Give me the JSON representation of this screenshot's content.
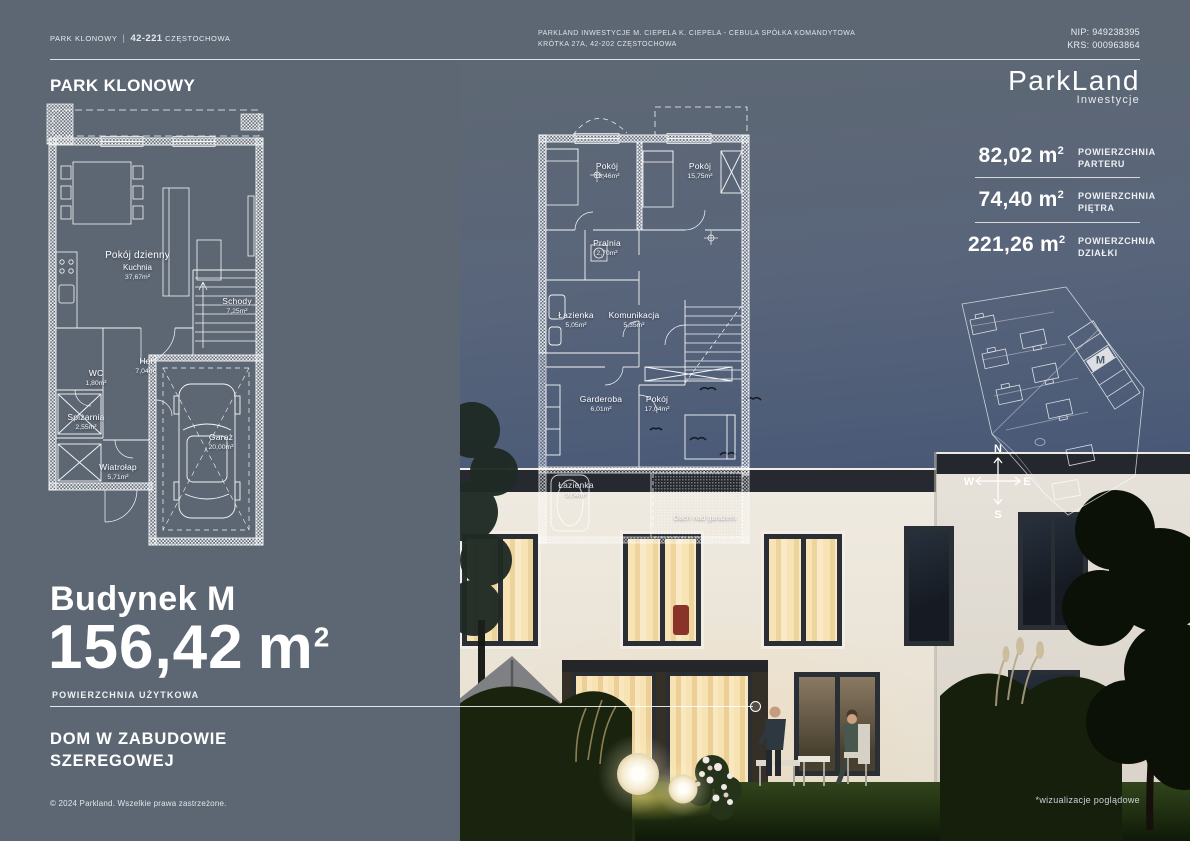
{
  "header": {
    "left_project": "PARK KLONOWY",
    "left_divider": "|",
    "left_zip": "42-221",
    "left_city": "CZĘSTOCHOWA",
    "center_line1": "PARKLAND INWESTYCJE M. CIEPELA K. CIEPELA - CEBULA SPÓŁKA KOMANDYTOWA",
    "center_line2": "KRÓTKA 27A, 42-202 CZĘSTOCHOWA",
    "nip": "NIP: 949238395",
    "krs": "KRS: 000963864"
  },
  "brand": {
    "name": "ParkLand",
    "subtitle": "Inwestycje"
  },
  "panel": {
    "project_title": "PARK KLONOWY",
    "building_title": "Budynek M",
    "area_value": "156,42",
    "area_unit": "m",
    "area_sup": "2",
    "area_label": "POWIERZCHNIA UŻYTKOWA",
    "type_line1": "DOM W ZABUDOWIE",
    "type_line2": "SZEREGOWEJ",
    "copyright": "© 2024 Parkland. Wszelkie prawa zastrzeżone."
  },
  "stats": [
    {
      "value": "82,02",
      "unit": "m",
      "sup": "2",
      "label1": "POWIERZCHNIA",
      "label2": "PARTERU"
    },
    {
      "value": "74,40",
      "unit": "m",
      "sup": "2",
      "label1": "POWIERZCHNIA",
      "label2": "PIĘTRA"
    },
    {
      "value": "221,26",
      "unit": "m",
      "sup": "2",
      "label1": "POWIERZCHNIA",
      "label2": "DZIAŁKI"
    }
  ],
  "ground_floor": {
    "rooms": [
      {
        "name": "Pokój dzienny",
        "name2": "Kuchnia",
        "area": "37,67m²"
      },
      {
        "name": "Schody",
        "area": "7,25m²"
      },
      {
        "name": "Hol",
        "area": "7,04m²"
      },
      {
        "name": "WC",
        "area": "1,80m²"
      },
      {
        "name": "Spiżarnia",
        "area": "2,55m²"
      },
      {
        "name": "Wiatrołap",
        "area": "5,71m²"
      },
      {
        "name": "Garaż",
        "area": "20,00m²"
      }
    ]
  },
  "first_floor": {
    "rooms": [
      {
        "name": "Pokój",
        "area": "13,46m²"
      },
      {
        "name": "Pokój",
        "area": "15,75m²"
      },
      {
        "name": "Pralnia",
        "area": "2,70m²"
      },
      {
        "name": "Łazienka",
        "area": "5,05m²"
      },
      {
        "name": "Komunikacja",
        "area": "5,35m²"
      },
      {
        "name": "Garderoba",
        "area": "6,01m²"
      },
      {
        "name": "Pokój",
        "area": "17,04m²"
      },
      {
        "name": "Łazienka",
        "area": "9,04m²"
      },
      {
        "name": "Dach nad garażem",
        "area": ""
      }
    ]
  },
  "site_plan": {
    "highlight_label": "M",
    "compass": {
      "n": "N",
      "e": "E",
      "s": "S",
      "w": "W"
    }
  },
  "footnote": "*wizualizacje poglądowe",
  "colors": {
    "slate": "#5d6774",
    "window_warm": "#f3d9a6",
    "blueprint": "#ffffff"
  }
}
